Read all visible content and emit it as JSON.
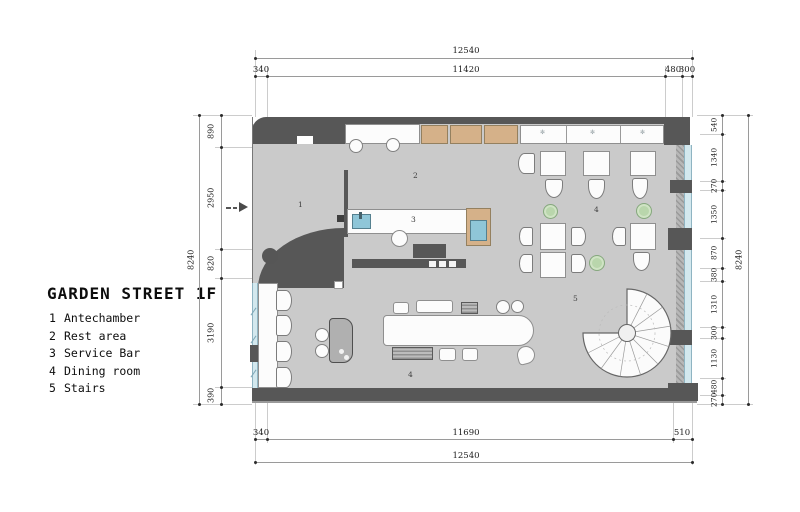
{
  "title": "GARDEN STREET 1F",
  "legend": {
    "items": [
      {
        "num": "1",
        "name": "Antechamber"
      },
      {
        "num": "2",
        "name": "Rest area"
      },
      {
        "num": "3",
        "name": "Service Bar"
      },
      {
        "num": "4",
        "name": "Dining room"
      },
      {
        "num": "5",
        "name": "Stairs"
      }
    ]
  },
  "plan_labels": {
    "antechamber": "1",
    "rest_area": "2",
    "service_bar": "3",
    "dining": "4",
    "dining2": "4",
    "stairs": "5"
  },
  "dimensions": {
    "top": {
      "overall": "12540",
      "seg": [
        "340",
        "11420",
        "480",
        "300"
      ]
    },
    "bottom": {
      "overall": "12540",
      "seg": [
        "340",
        "11690",
        "510"
      ]
    },
    "left": {
      "overall": "8240",
      "seg": [
        "890",
        "2950",
        "820",
        "3190",
        "390"
      ]
    },
    "right": {
      "overall": "8240",
      "seg": [
        "540",
        "1340",
        "270",
        "1350",
        "870",
        "380",
        "1310",
        "300",
        "1130",
        "480",
        "270"
      ]
    }
  },
  "icons": {
    "windowsill_plant": "✻"
  },
  "colors": {
    "wall": "#575757",
    "floor": "#cacaca",
    "wood": "#d5b189",
    "water": "#8fc6d8",
    "glass": "#d3e8ee",
    "plant": "#b9d6ac"
  }
}
